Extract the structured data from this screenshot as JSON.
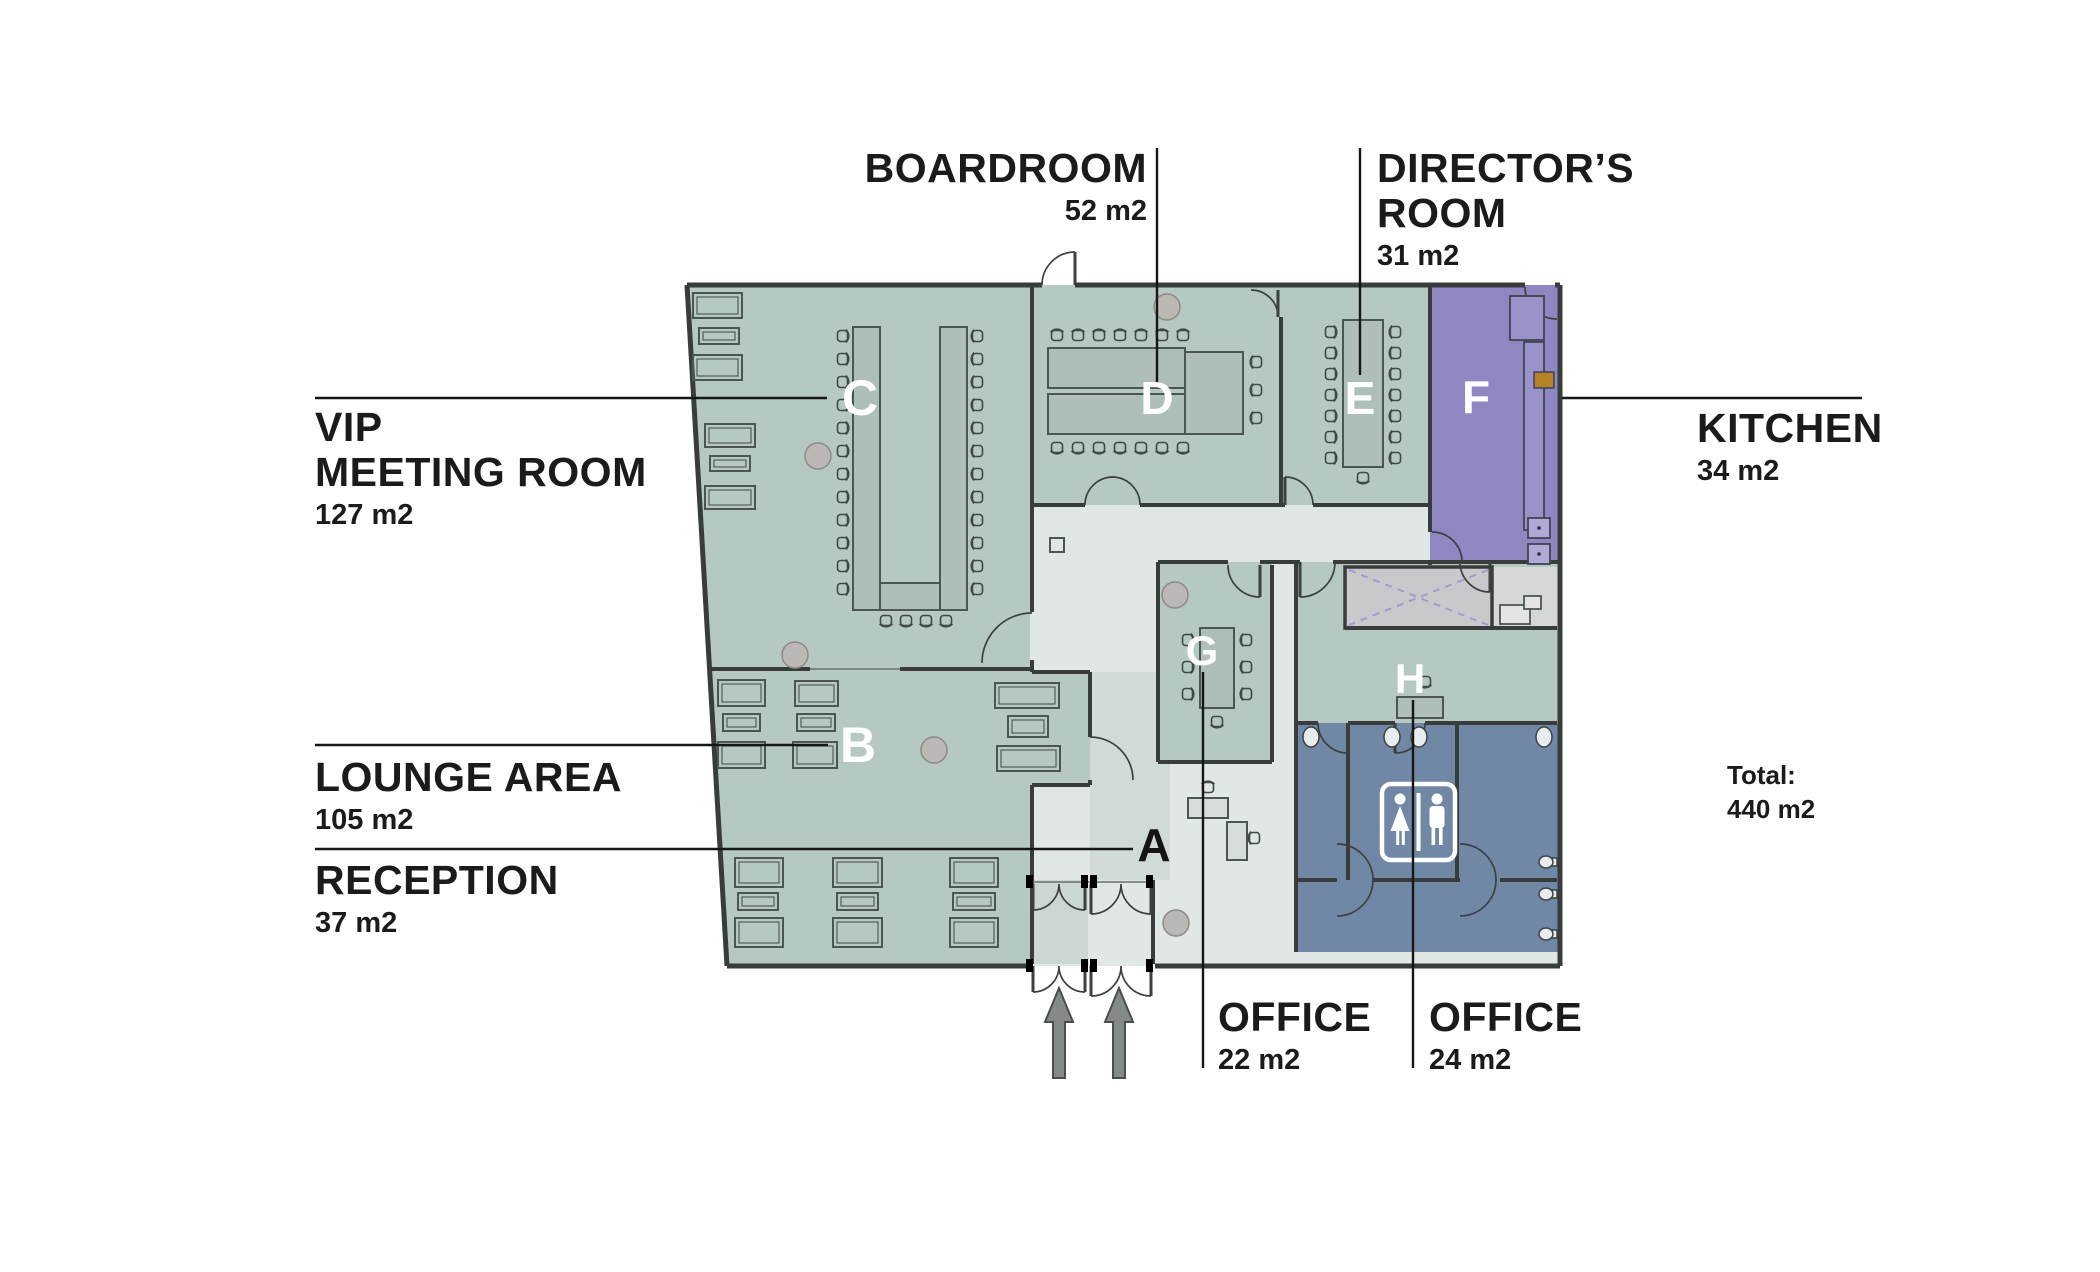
{
  "callouts": {
    "vip": {
      "line1": "VIP",
      "line2": "MEETING ROOM",
      "area": "127 m2"
    },
    "lounge": {
      "title": "LOUNGE AREA",
      "area": "105 m2"
    },
    "reception": {
      "title": "RECEPTION",
      "area": "37 m2"
    },
    "boardroom": {
      "title": "BOARDROOM",
      "area": "52 m2"
    },
    "directors": {
      "line1": "DIRECTOR’S",
      "line2": "ROOM",
      "area": "31 m2"
    },
    "kitchen": {
      "title": "KITCHEN",
      "area": "34 m2"
    },
    "office_g": {
      "title": "OFFICE",
      "area": "22 m2"
    },
    "office_h": {
      "title": "OFFICE",
      "area": "24 m2"
    },
    "total": {
      "label": "Total:",
      "value": "440 m2"
    }
  },
  "rooms": {
    "a": "A",
    "b": "B",
    "c": "C",
    "d": "D",
    "e": "E",
    "f": "F",
    "g": "G",
    "h": "H"
  },
  "colors": {
    "room_green": "#b5c8c1",
    "corridor": "#e0e7e4",
    "kitchen_purple": "#8e87c1",
    "toilet_blue": "#7088a5",
    "elevator_gray": "#c9c9cb",
    "wall": "#383d3c",
    "text": "#1b1b1b"
  }
}
